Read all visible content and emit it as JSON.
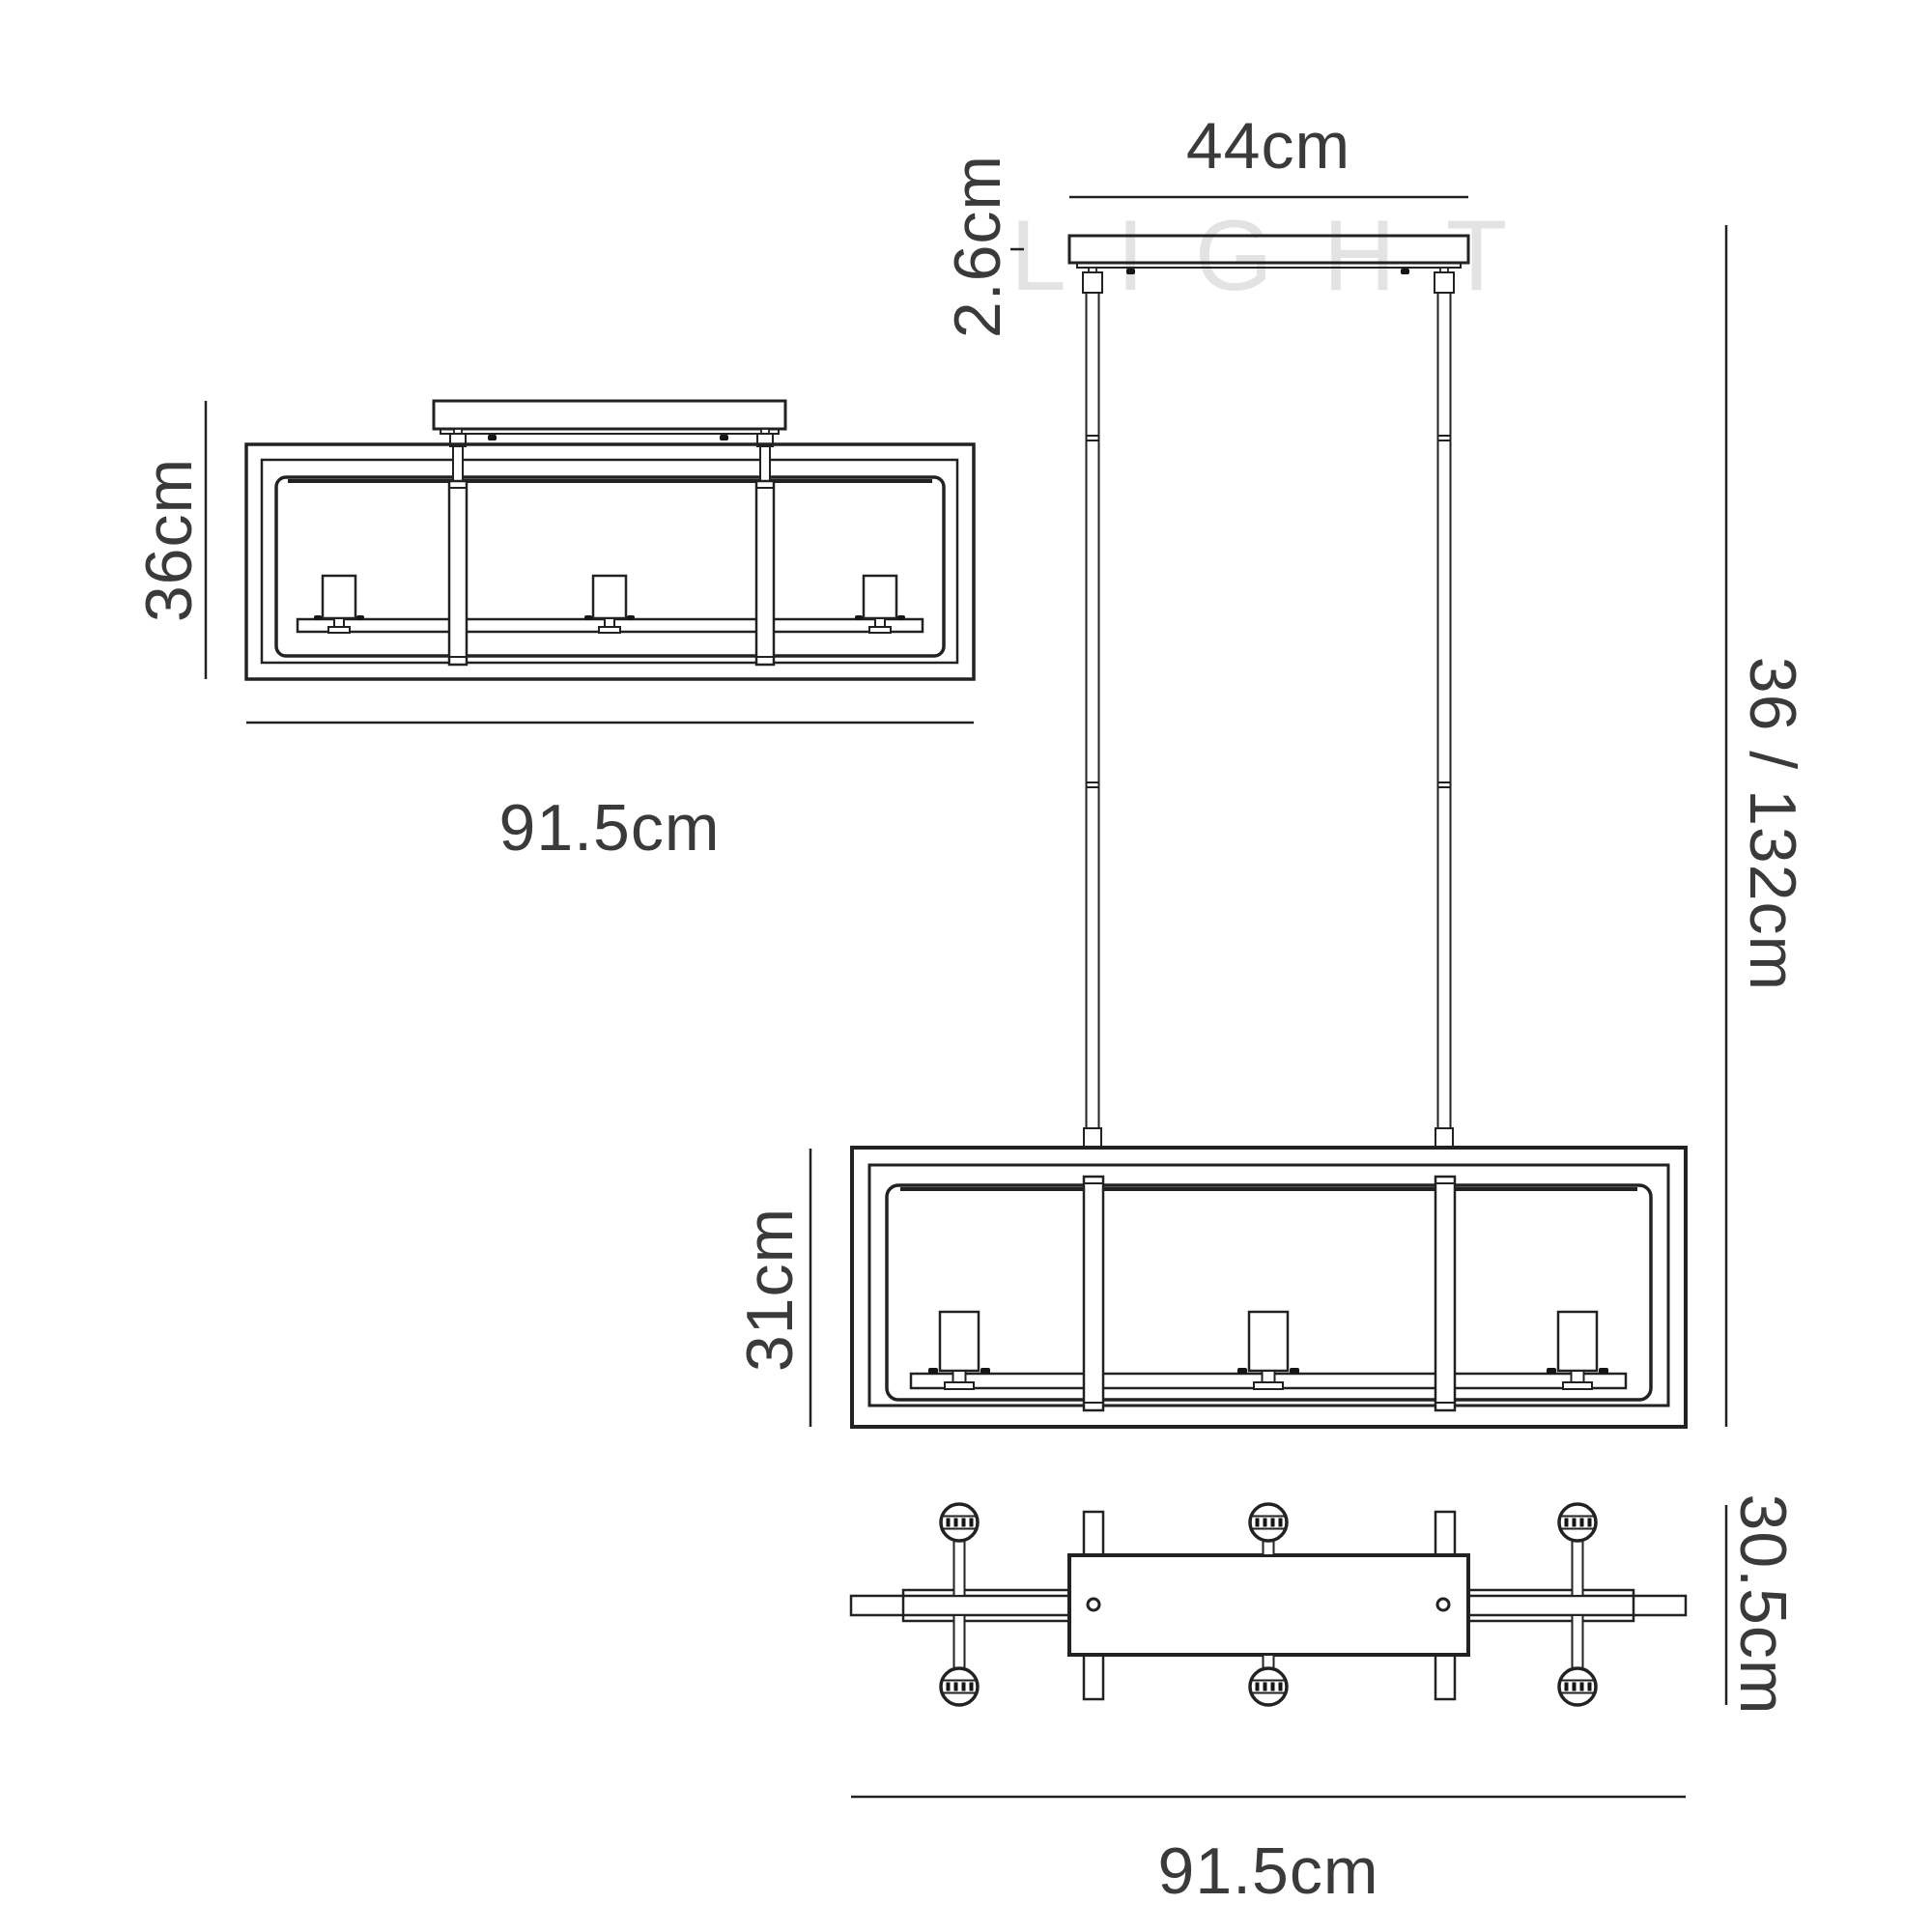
{
  "watermark": "LIGHT",
  "views": {
    "semi_flush": {
      "height_label": "36cm",
      "width_label": "91.5cm"
    },
    "pendant": {
      "canopy_width_label": "44cm",
      "canopy_thickness_label": "2.6cm",
      "drop_height_label": "36 / 132cm",
      "frame_height_label": "31cm"
    },
    "plan": {
      "depth_label": "30.5cm",
      "width_label": "91.5cm"
    }
  },
  "colors": {
    "line": "#222222",
    "text": "#3a3a3a",
    "watermark": "#e3e3e3",
    "background": "#ffffff"
  }
}
